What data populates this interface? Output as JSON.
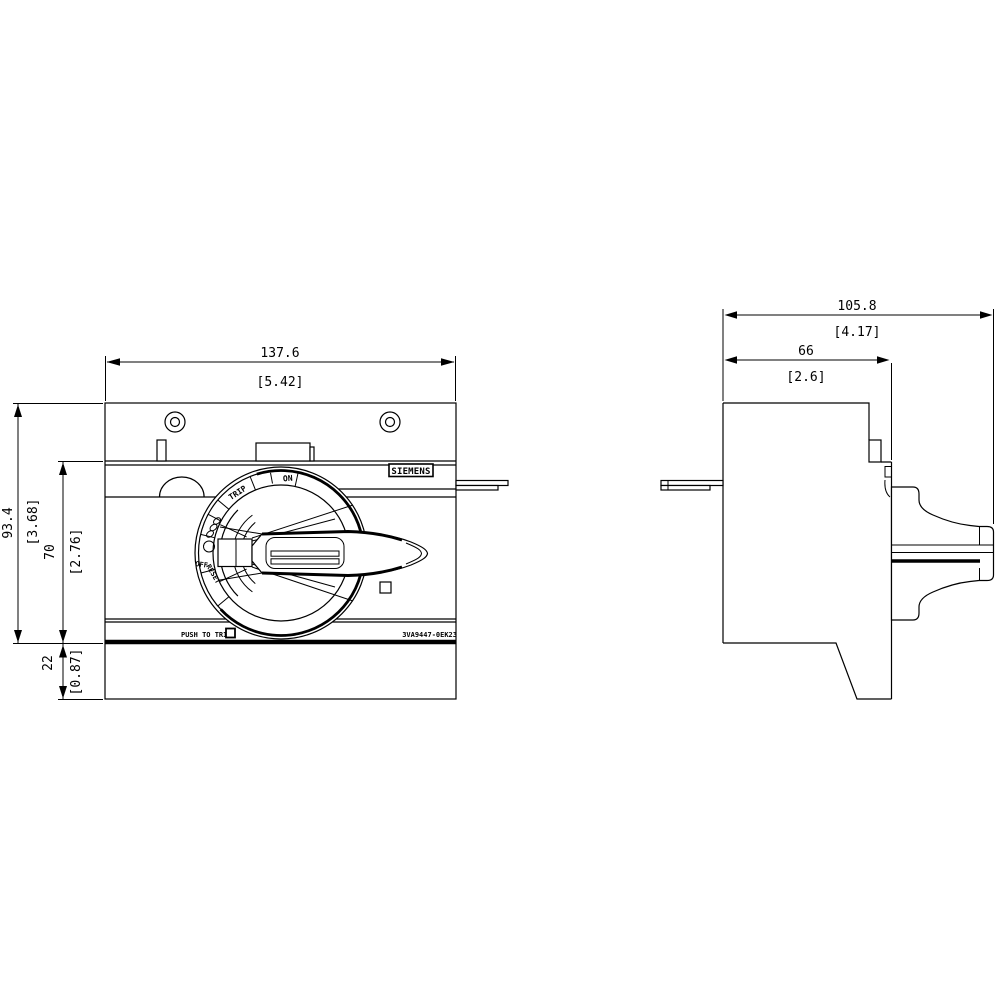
{
  "drawing": {
    "type": "engineering-dimension-drawing",
    "colors": {
      "line": "#000000",
      "background": "#ffffff"
    },
    "labels": {
      "brand": "SIEMENS",
      "push_to_trip": "PUSH TO TRIP",
      "part_number": "3VA9447-0EK23",
      "dial": {
        "trip": "TRIP",
        "on": "ON",
        "off": "OFF",
        "reset": "RESET"
      }
    },
    "front_view": {
      "dims": {
        "width_mm": "137.6",
        "width_in": "[5.42]",
        "height_mm": "93.4",
        "height_in": "[3.68]",
        "mid_height_mm": "70",
        "mid_height_in": "[2.76]",
        "base_height_mm": "22",
        "base_height_in": "[0.87]"
      }
    },
    "side_view": {
      "dims": {
        "total_depth_mm": "105.8",
        "total_depth_in": "[4.17]",
        "body_depth_mm": "66",
        "body_depth_in": "[2.6]"
      }
    }
  }
}
